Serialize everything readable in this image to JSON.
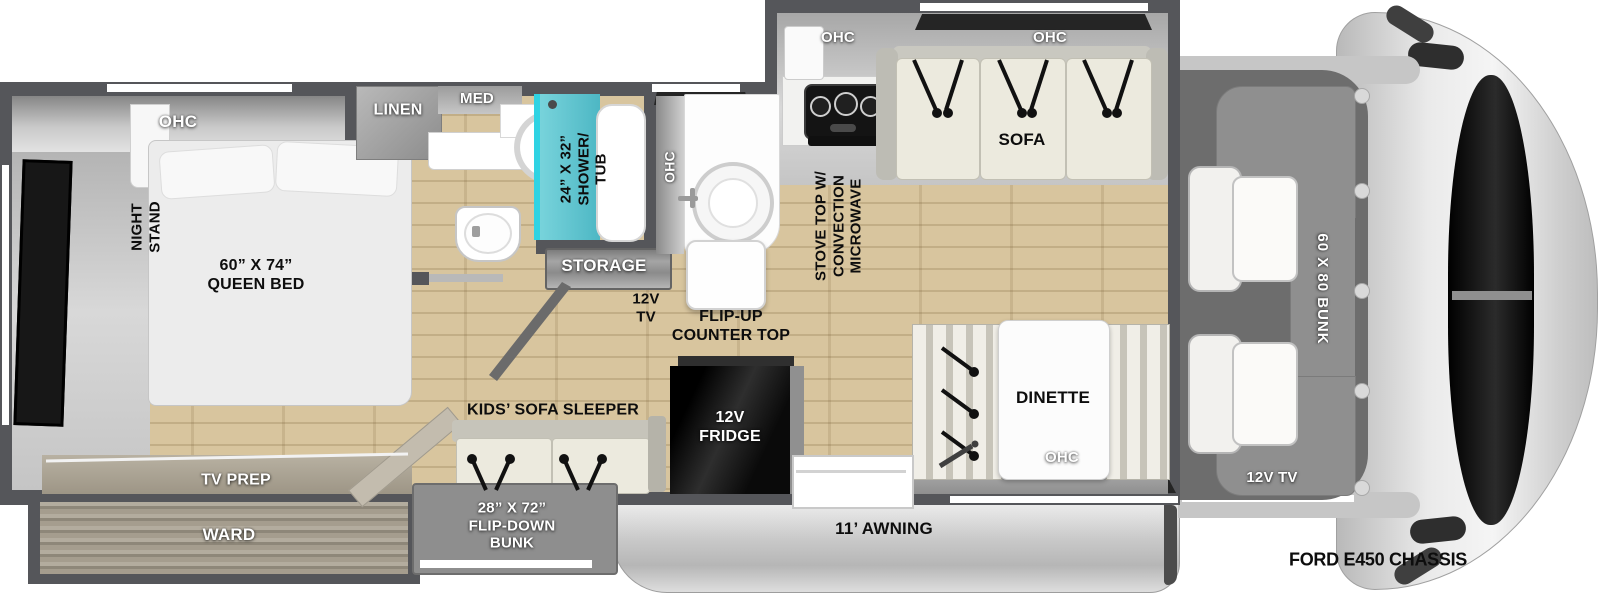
{
  "floorplan": {
    "chassis_label": "FORD E450 CHASSIS",
    "awning": "11’ AWNING",
    "bedroom": {
      "ohc": "OHC",
      "night_stand": "NIGHT\nSTAND",
      "queen_bed": "60” X 74”\nQUEEN BED",
      "tv_prep": "TV PREP",
      "ward": "WARD"
    },
    "bathroom": {
      "linen": "LINEN",
      "med": "MED",
      "shower_tub": "24” X 32”\nSHOWER/\nTUB"
    },
    "kitchen": {
      "ohc": "OHC",
      "storage": "STORAGE",
      "tv_12v": "12V\nTV",
      "flip_up_counter": "FLIP-UP\nCOUNTER TOP",
      "stove": "STOVE TOP W/\nCONVECTION\nMICROWAVE",
      "ohc_stove": "OHC",
      "fridge": "12V\nFRIDGE"
    },
    "living": {
      "ohc_sofa": "OHC",
      "sofa": "SOFA",
      "dinette": "DINETTE",
      "ohc_dinette": "OHC",
      "kids_sofa_sleeper": "KIDS’ SOFA SLEEPER",
      "flip_down_bunk": "28” X 72”\nFLIP-DOWN\nBUNK"
    },
    "cab": {
      "bunk": "60 X 80 BUNK",
      "tv_12v": "12V TV"
    },
    "palette": {
      "wall": "#55565a",
      "wood_floor": "#d8c59e",
      "shower_teal": "#4db7c4",
      "awning_gray": "#c9c9c9",
      "fridge_black": "#111111"
    }
  }
}
